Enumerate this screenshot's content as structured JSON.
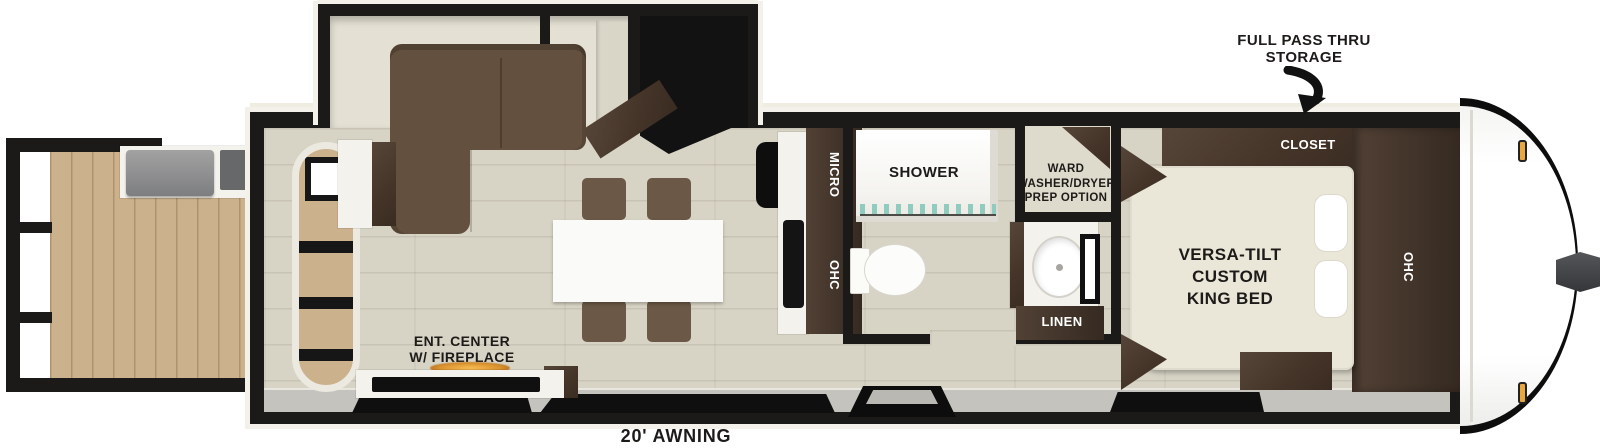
{
  "labels": {
    "storage_line1": "FULL PASS THRU",
    "storage_line2": "STORAGE",
    "closet": "CLOSET",
    "bedroom_ohc": "OHC",
    "bed_line1": "VERSA-TILT",
    "bed_line2": "CUSTOM",
    "bed_line3": "KING BED",
    "ward_line1": "WARD",
    "ward_line2": "WASHER/DRYER",
    "ward_line3": "PREP OPTION",
    "shower": "SHOWER",
    "linen": "LINEN",
    "micro": "MICRO",
    "kitchen_ohc": "OHC",
    "sofa": "SOFA",
    "pantry": "PANTRY",
    "fridge": "FRIDGE",
    "ent_line1": "ENT. CENTER",
    "ent_line2": "W/ FIREPLACE",
    "awning": "20' AWNING"
  },
  "colors": {
    "wall": "#1c1a18",
    "floor": "#d7d3c5",
    "deck_wood": "#cbb18c",
    "cabinet_dark": "#4a3b31",
    "sofa_brown": "#63503e",
    "chair_brown": "#6b5846",
    "bed_cream": "#ebe7d8",
    "exterior_gray": "#c4c3be",
    "flame_orange": "#d9912c",
    "marker_amber": "#e8a83e",
    "glass_teal": "#8fccbf",
    "label_dark": "#1d1b19",
    "trim_white": "#f3f1e9"
  }
}
